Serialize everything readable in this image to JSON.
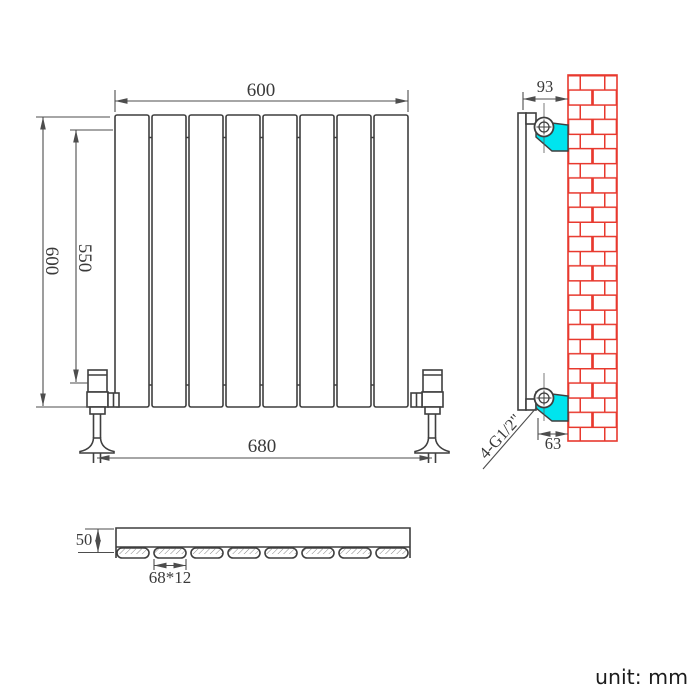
{
  "front_view": {
    "panel_count": 8,
    "dim_width": "600",
    "dim_height": "600",
    "dim_height_inner": "550",
    "dim_valve_span": "680"
  },
  "side_view": {
    "dim_depth_top": "93",
    "dim_bottom_offset": "63",
    "connection_label": "4-G1/2\""
  },
  "top_view": {
    "dim_depth": "50",
    "dim_panel_section": "68*12"
  },
  "unit_note": "unit: mm",
  "colors": {
    "bracket_cyan": "#00E4EE",
    "brick_red": "#E8392E",
    "line_dark": "#3F3F3F"
  }
}
